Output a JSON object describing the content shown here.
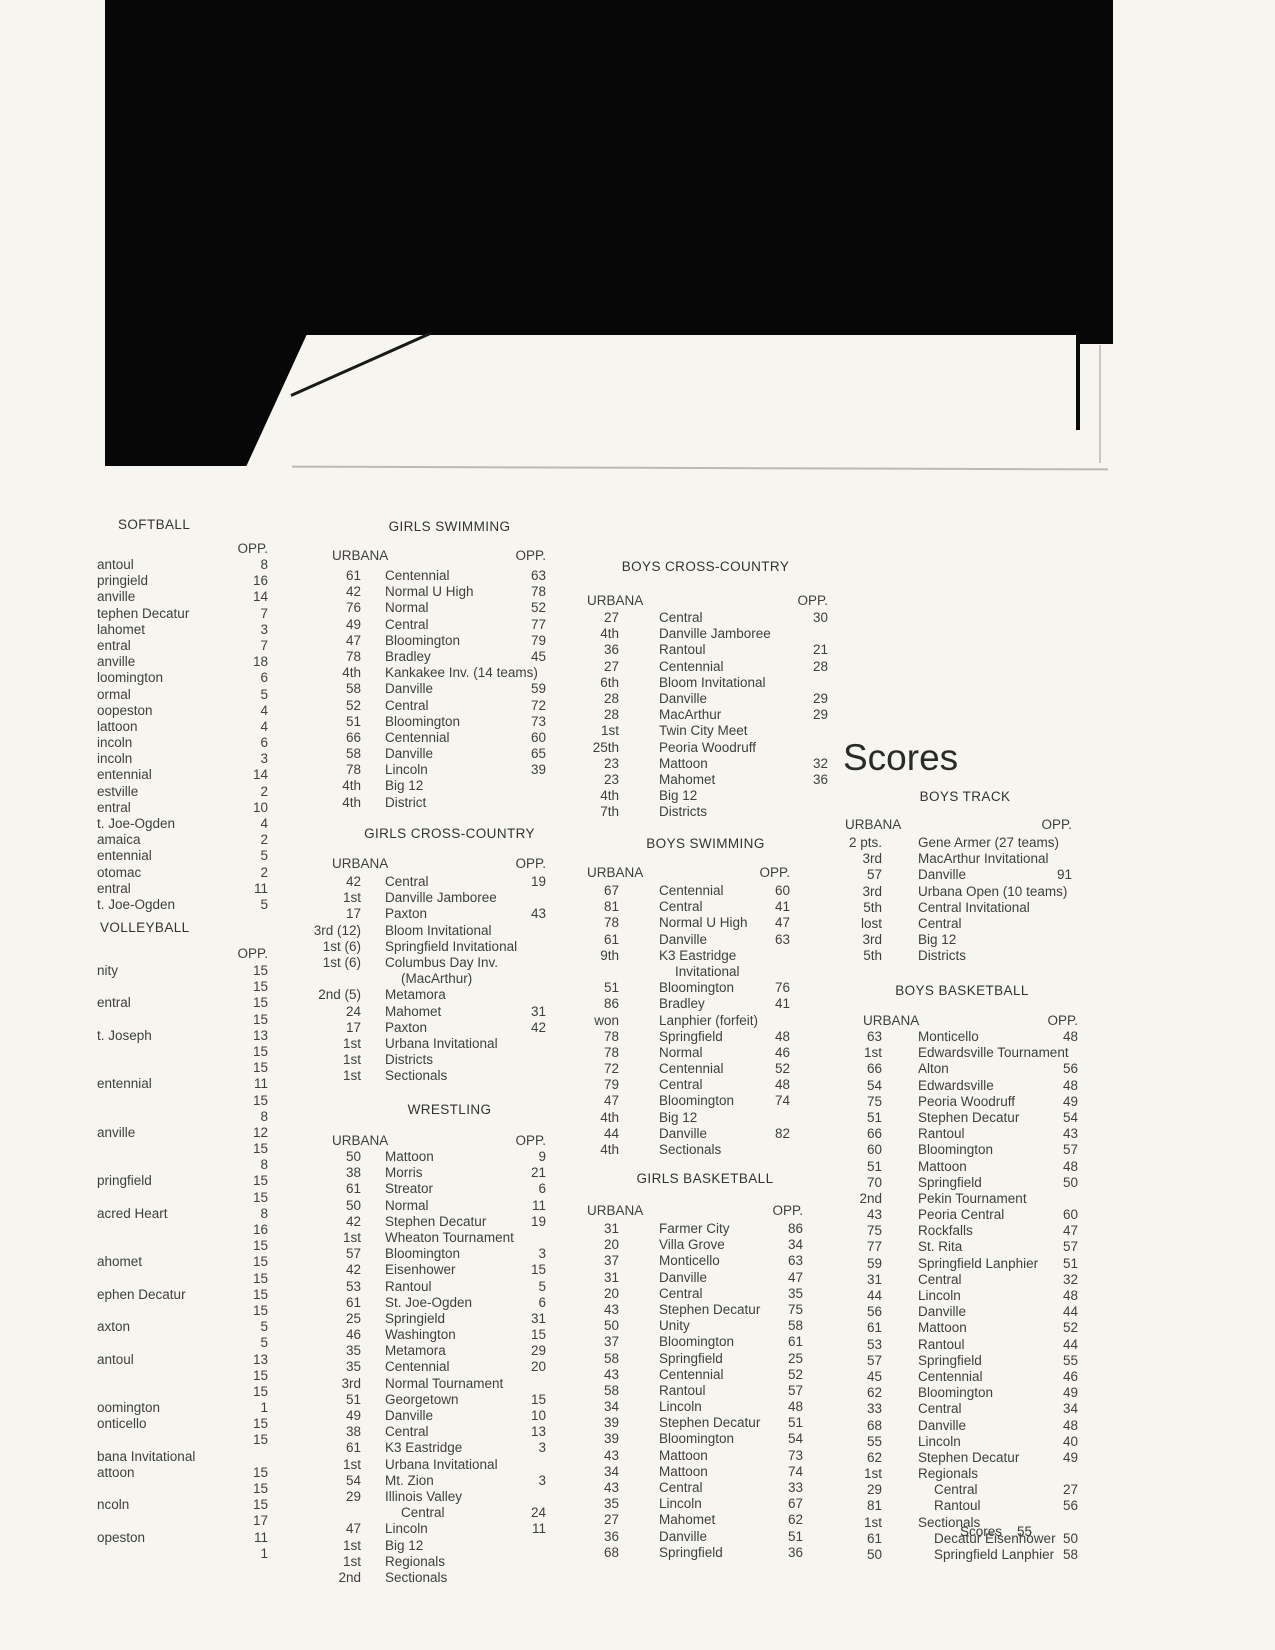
{
  "page": {
    "big_title": "Scores",
    "footer_label": "Scores",
    "footer_page": "55"
  },
  "colors": {
    "page_bg": "#f6f5f0",
    "text": "#3f3f3f",
    "scan_black": "#070707"
  },
  "sections": {
    "softball": {
      "title": "SOFTBALL",
      "urbana_label": "",
      "opp_label": "OPP.",
      "rows": [
        [
          "",
          "antoul",
          "8"
        ],
        [
          "",
          "pringield",
          "16"
        ],
        [
          "",
          "anville",
          "14"
        ],
        [
          "",
          "tephen Decatur",
          "7"
        ],
        [
          "",
          "lahomet",
          "3"
        ],
        [
          "",
          "entral",
          "7"
        ],
        [
          "",
          "anville",
          "18"
        ],
        [
          "",
          "loomington",
          "6"
        ],
        [
          "",
          "ormal",
          "5"
        ],
        [
          "",
          "oopeston",
          "4"
        ],
        [
          "",
          "lattoon",
          "4"
        ],
        [
          "",
          "incoln",
          "6"
        ],
        [
          "",
          "incoln",
          "3"
        ],
        [
          "",
          "entennial",
          "14"
        ],
        [
          "",
          "estville",
          "2"
        ],
        [
          "",
          "entral",
          "10"
        ],
        [
          "",
          "t. Joe-Ogden",
          "4"
        ],
        [
          "",
          "amaica",
          "2"
        ],
        [
          "",
          "entennial",
          "5"
        ],
        [
          "",
          "otomac",
          "2"
        ],
        [
          "",
          "entral",
          "11"
        ],
        [
          "",
          "t. Joe-Ogden",
          "5"
        ]
      ]
    },
    "volleyball": {
      "title": "VOLLEYBALL",
      "urbana_label": "",
      "opp_label": "OPP.",
      "rows": [
        [
          "",
          "nity",
          "15"
        ],
        [
          "",
          "",
          "15"
        ],
        [
          "",
          "entral",
          "15"
        ],
        [
          "",
          "",
          "15"
        ],
        [
          "",
          "t. Joseph",
          "13"
        ],
        [
          "",
          "",
          "15"
        ],
        [
          "",
          "",
          "15"
        ],
        [
          "",
          "entennial",
          "11"
        ],
        [
          "",
          "",
          "15"
        ],
        [
          "",
          "",
          "8"
        ],
        [
          "",
          "anville",
          "12"
        ],
        [
          "",
          "",
          "15"
        ],
        [
          "",
          "",
          "8"
        ],
        [
          "",
          "pringfield",
          "15"
        ],
        [
          "",
          "",
          "15"
        ],
        [
          "",
          "acred Heart",
          "8"
        ],
        [
          "",
          "",
          "16"
        ],
        [
          "",
          "",
          "15"
        ],
        [
          "",
          "ahomet",
          "15"
        ],
        [
          "",
          "",
          "15"
        ],
        [
          "",
          "ephen Decatur",
          "15"
        ],
        [
          "",
          "",
          "15"
        ],
        [
          "",
          "axton",
          "5"
        ],
        [
          "",
          "",
          "5"
        ],
        [
          "",
          "antoul",
          "13"
        ],
        [
          "",
          "",
          "15"
        ],
        [
          "",
          "",
          "15"
        ],
        [
          "",
          "oomington",
          "1"
        ],
        [
          "",
          "onticello",
          "15"
        ],
        [
          "",
          "",
          "15"
        ],
        [
          "",
          "bana Invitational",
          ""
        ],
        [
          "",
          "attoon",
          "15"
        ],
        [
          "",
          "",
          "15"
        ],
        [
          "",
          "ncoln",
          "15"
        ],
        [
          "",
          "",
          "17"
        ],
        [
          "",
          "opeston",
          "11"
        ],
        [
          "",
          "",
          "1"
        ]
      ]
    },
    "girls_swimming": {
      "title": "GIRLS SWIMMING",
      "urbana_label": "URBANA",
      "opp_label": "OPP.",
      "rows": [
        [
          "61",
          "Centennial",
          "63"
        ],
        [
          "42",
          "Normal U High",
          "78"
        ],
        [
          "76",
          "Normal",
          "52"
        ],
        [
          "49",
          "Central",
          "77"
        ],
        [
          "47",
          "Bloomington",
          "79"
        ],
        [
          "78",
          "Bradley",
          "45"
        ],
        [
          "4th",
          "Kankakee Inv. (14 teams)",
          ""
        ],
        [
          "58",
          "Danville",
          "59"
        ],
        [
          "52",
          "Central",
          "72"
        ],
        [
          "51",
          "Bloomington",
          "73"
        ],
        [
          "66",
          "Centennial",
          "60"
        ],
        [
          "58",
          "Danville",
          "65"
        ],
        [
          "78",
          "Lincoln",
          "39"
        ],
        [
          "4th",
          "Big 12",
          ""
        ],
        [
          "4th",
          "District",
          ""
        ]
      ]
    },
    "girls_cross_country": {
      "title": "GIRLS CROSS-COUNTRY",
      "urbana_label": "URBANA",
      "opp_label": "OPP.",
      "rows": [
        [
          "42",
          "Central",
          "19"
        ],
        [
          "1st",
          "Danville Jamboree",
          ""
        ],
        [
          "17",
          "Paxton",
          "43"
        ],
        [
          "3rd (12)",
          "Bloom Invitational",
          ""
        ],
        [
          "1st (6)",
          "Springfield Invitational",
          ""
        ],
        [
          "1st (6)",
          "Columbus Day Inv.",
          ""
        ],
        [
          "",
          "(MacArthur)",
          "",
          1
        ],
        [
          "2nd (5)",
          "Metamora",
          ""
        ],
        [
          "24",
          "Mahomet",
          "31"
        ],
        [
          "17",
          "Paxton",
          "42"
        ],
        [
          "1st",
          "Urbana Invitational",
          ""
        ],
        [
          "1st",
          "Districts",
          ""
        ],
        [
          "1st",
          "Sectionals",
          ""
        ]
      ]
    },
    "wrestling": {
      "title": "WRESTLING",
      "urbana_label": "URBANA",
      "opp_label": "OPP.",
      "rows": [
        [
          "50",
          "Mattoon",
          "9"
        ],
        [
          "38",
          "Morris",
          "21"
        ],
        [
          "61",
          "Streator",
          "6"
        ],
        [
          "50",
          "Normal",
          "11"
        ],
        [
          "42",
          "Stephen Decatur",
          "19"
        ],
        [
          "1st",
          "Wheaton Tournament",
          ""
        ],
        [
          "57",
          "Bloomington",
          "3"
        ],
        [
          "42",
          "Eisenhower",
          "15"
        ],
        [
          "53",
          "Rantoul",
          "5"
        ],
        [
          "61",
          "St. Joe-Ogden",
          "6"
        ],
        [
          "25",
          "Springield",
          "31"
        ],
        [
          "46",
          "Washington",
          "15"
        ],
        [
          "35",
          "Metamora",
          "29"
        ],
        [
          "35",
          "Centennial",
          "20"
        ],
        [
          "3rd",
          "Normal Tournament",
          ""
        ],
        [
          "51",
          "Georgetown",
          "15"
        ],
        [
          "49",
          "Danville",
          "10"
        ],
        [
          "38",
          "Central",
          "13"
        ],
        [
          "61",
          "K3 Eastridge",
          "3"
        ],
        [
          "1st",
          "Urbana Invitational",
          ""
        ],
        [
          "54",
          "Mt. Zion",
          "3"
        ],
        [
          "29",
          "Illinois Valley",
          ""
        ],
        [
          "",
          "Central",
          "24",
          1
        ],
        [
          "47",
          "Lincoln",
          "11"
        ],
        [
          "1st",
          "Big 12",
          ""
        ],
        [
          "1st",
          "Regionals",
          ""
        ],
        [
          "2nd",
          "Sectionals",
          ""
        ]
      ]
    },
    "boys_cross_country": {
      "title": "BOYS CROSS-COUNTRY",
      "urbana_label": "URBANA",
      "opp_label": "OPP.",
      "rows": [
        [
          "27",
          "Central",
          "30"
        ],
        [
          "4th",
          "Danville Jamboree",
          ""
        ],
        [
          "36",
          "Rantoul",
          "21"
        ],
        [
          "27",
          "Centennial",
          "28"
        ],
        [
          "6th",
          "Bloom Invitational",
          ""
        ],
        [
          "28",
          "Danville",
          "29"
        ],
        [
          "28",
          "MacArthur",
          "29"
        ],
        [
          "1st",
          "Twin City Meet",
          ""
        ],
        [
          "25th",
          "Peoria Woodruff",
          ""
        ],
        [
          "23",
          "Mattoon",
          "32"
        ],
        [
          "23",
          "Mahomet",
          "36"
        ],
        [
          "4th",
          "Big 12",
          ""
        ],
        [
          "7th",
          "Districts",
          ""
        ]
      ]
    },
    "boys_swimming": {
      "title": "BOYS SWIMMING",
      "urbana_label": "URBANA",
      "opp_label": "OPP.",
      "rows": [
        [
          "67",
          "Centennial",
          "60"
        ],
        [
          "81",
          "Central",
          "41"
        ],
        [
          "78",
          "Normal U High",
          "47"
        ],
        [
          "61",
          "Danville",
          "63"
        ],
        [
          "9th",
          "K3 Eastridge",
          ""
        ],
        [
          "",
          "Invitational",
          "",
          1
        ],
        [
          "51",
          "Bloomington",
          "76"
        ],
        [
          "86",
          "Bradley",
          "41"
        ],
        [
          "won",
          "Lanphier (forfeit)",
          ""
        ],
        [
          "78",
          "Springfield",
          "48"
        ],
        [
          "78",
          "Normal",
          "46"
        ],
        [
          "72",
          "Centennial",
          "52"
        ],
        [
          "79",
          "Central",
          "48"
        ],
        [
          "47",
          "Bloomington",
          "74"
        ],
        [
          "4th",
          "Big 12",
          ""
        ],
        [
          "44",
          "Danville",
          "82"
        ],
        [
          "4th",
          "Sectionals",
          ""
        ]
      ]
    },
    "girls_basketball": {
      "title": "GIRLS BASKETBALL",
      "urbana_label": "URBANA",
      "opp_label": "OPP.",
      "rows": [
        [
          "31",
          "Farmer City",
          "86"
        ],
        [
          "20",
          "Villa Grove",
          "34"
        ],
        [
          "37",
          "Monticello",
          "63"
        ],
        [
          "31",
          "Danville",
          "47"
        ],
        [
          "20",
          "Central",
          "35"
        ],
        [
          "43",
          "Stephen Decatur",
          "75"
        ],
        [
          "50",
          "Unity",
          "58"
        ],
        [
          "37",
          "Bloomington",
          "61"
        ],
        [
          "58",
          "Springfield",
          "25"
        ],
        [
          "43",
          "Centennial",
          "52"
        ],
        [
          "58",
          "Rantoul",
          "57"
        ],
        [
          "34",
          "Lincoln",
          "48"
        ],
        [
          "39",
          "Stephen Decatur",
          "51"
        ],
        [
          "39",
          "Bloomington",
          "54"
        ],
        [
          "43",
          "Mattoon",
          "73"
        ],
        [
          "34",
          "Mattoon",
          "74"
        ],
        [
          "43",
          "Central",
          "33"
        ],
        [
          "35",
          "Lincoln",
          "67"
        ],
        [
          "27",
          "Mahomet",
          "62"
        ],
        [
          "36",
          "Danville",
          "51"
        ],
        [
          "68",
          "Springfield",
          "36"
        ]
      ]
    },
    "boys_track": {
      "title": "BOYS TRACK",
      "urbana_label": "URBANA",
      "opp_label": "OPP.",
      "rows": [
        [
          "2 pts.",
          "Gene Armer (27 teams)",
          ""
        ],
        [
          "3rd",
          "MacArthur Invitational",
          ""
        ],
        [
          "57",
          "Danville",
          "91"
        ],
        [
          "3rd",
          "Urbana Open (10 teams)",
          ""
        ],
        [
          "5th",
          "Central Invitational",
          ""
        ],
        [
          "lost",
          "Central",
          ""
        ],
        [
          "3rd",
          "Big 12",
          ""
        ],
        [
          "5th",
          "Districts",
          ""
        ]
      ]
    },
    "boys_basketball": {
      "title": "BOYS BASKETBALL",
      "urbana_label": "URBANA",
      "opp_label": "OPP.",
      "rows": [
        [
          "63",
          "Monticello",
          "48"
        ],
        [
          "1st",
          "Edwardsville Tournament",
          ""
        ],
        [
          "66",
          "Alton",
          "56"
        ],
        [
          "54",
          "Edwardsville",
          "48"
        ],
        [
          "75",
          "Peoria Woodruff",
          "49"
        ],
        [
          "51",
          "Stephen Decatur",
          "54"
        ],
        [
          "66",
          "Rantoul",
          "43"
        ],
        [
          "60",
          "Bloomington",
          "57"
        ],
        [
          "51",
          "Mattoon",
          "48"
        ],
        [
          "70",
          "Springfield",
          "50"
        ],
        [
          "2nd",
          "Pekin Tournament",
          ""
        ],
        [
          "43",
          "Peoria Central",
          "60"
        ],
        [
          "75",
          "Rockfalls",
          "47"
        ],
        [
          "77",
          "St. Rita",
          "57"
        ],
        [
          "59",
          "Springfield Lanphier",
          "51"
        ],
        [
          "31",
          "Central",
          "32"
        ],
        [
          "44",
          "Lincoln",
          "48"
        ],
        [
          "56",
          "Danville",
          "44"
        ],
        [
          "61",
          "Mattoon",
          "52"
        ],
        [
          "53",
          "Rantoul",
          "44"
        ],
        [
          "57",
          "Springfield",
          "55"
        ],
        [
          "45",
          "Centennial",
          "46"
        ],
        [
          "62",
          "Bloomington",
          "49"
        ],
        [
          "33",
          "Central",
          "34"
        ],
        [
          "68",
          "Danville",
          "48"
        ],
        [
          "55",
          "Lincoln",
          "40"
        ],
        [
          "62",
          "Stephen Decatur",
          "49"
        ],
        [
          "1st",
          "Regionals",
          ""
        ],
        [
          "29",
          "Central",
          "27",
          1
        ],
        [
          "81",
          "Rantoul",
          "56",
          1
        ],
        [
          "1st",
          "Sectionals",
          ""
        ],
        [
          "61",
          "Decatur Eisenhower",
          "50",
          1
        ],
        [
          "50",
          "Springfield Lanphier",
          "58",
          1
        ]
      ]
    }
  }
}
